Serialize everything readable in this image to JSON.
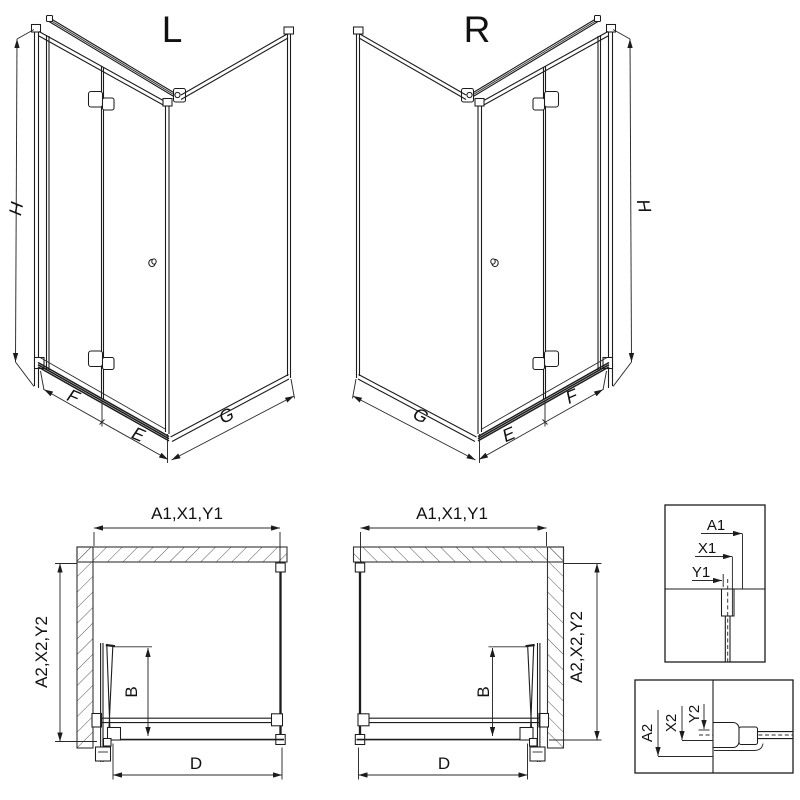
{
  "drawing": {
    "iso_left": {
      "title": "L",
      "height_dim": "H",
      "wall_panel_dim": "F",
      "door_dim": "E",
      "side_panel_dim": "G"
    },
    "iso_right": {
      "title": "R",
      "height_dim": "H",
      "wall_panel_dim": "F",
      "door_dim": "E",
      "side_panel_dim": "G"
    },
    "plan_left": {
      "width_dim": "A1,X1,Y1",
      "depth_dim": "A2,X2,Y2",
      "door_projection_dim": "B",
      "entry_width_dim": "D"
    },
    "plan_right": {
      "width_dim": "A1,X1,Y1",
      "depth_dim": "A2,X2,Y2",
      "door_projection_dim": "B",
      "entry_width_dim": "D"
    },
    "detail_top": {
      "dim1": "A1",
      "dim2": "X1",
      "dim3": "Y1"
    },
    "detail_bottom": {
      "dim1": "A2",
      "dim2": "X2",
      "dim3": "Y2"
    }
  },
  "colors": {
    "line": "#1c1c1c",
    "background": "#ffffff",
    "hatch": "#555555"
  }
}
